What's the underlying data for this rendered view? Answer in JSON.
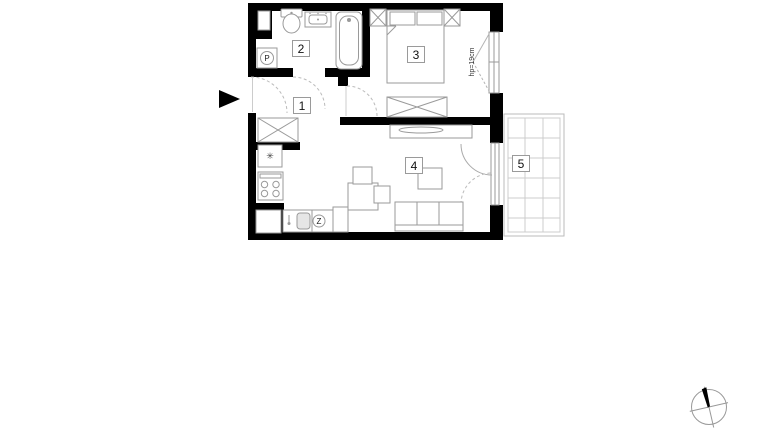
{
  "floorplan": {
    "room_labels": [
      "1",
      "2",
      "3",
      "4",
      "5"
    ],
    "window_annotation": "hp=19cm",
    "markers": {
      "washing_machine": "P",
      "dishwasher": "Z",
      "kitchen_symbol": "✳"
    },
    "colors": {
      "wall": "#000000",
      "furniture_outline": "#9a9a9a",
      "dashed_guide": "#bbbbbb",
      "balcony_grid": "#cccccc",
      "entrance_arrow": "#000000",
      "background": "#ffffff"
    }
  }
}
